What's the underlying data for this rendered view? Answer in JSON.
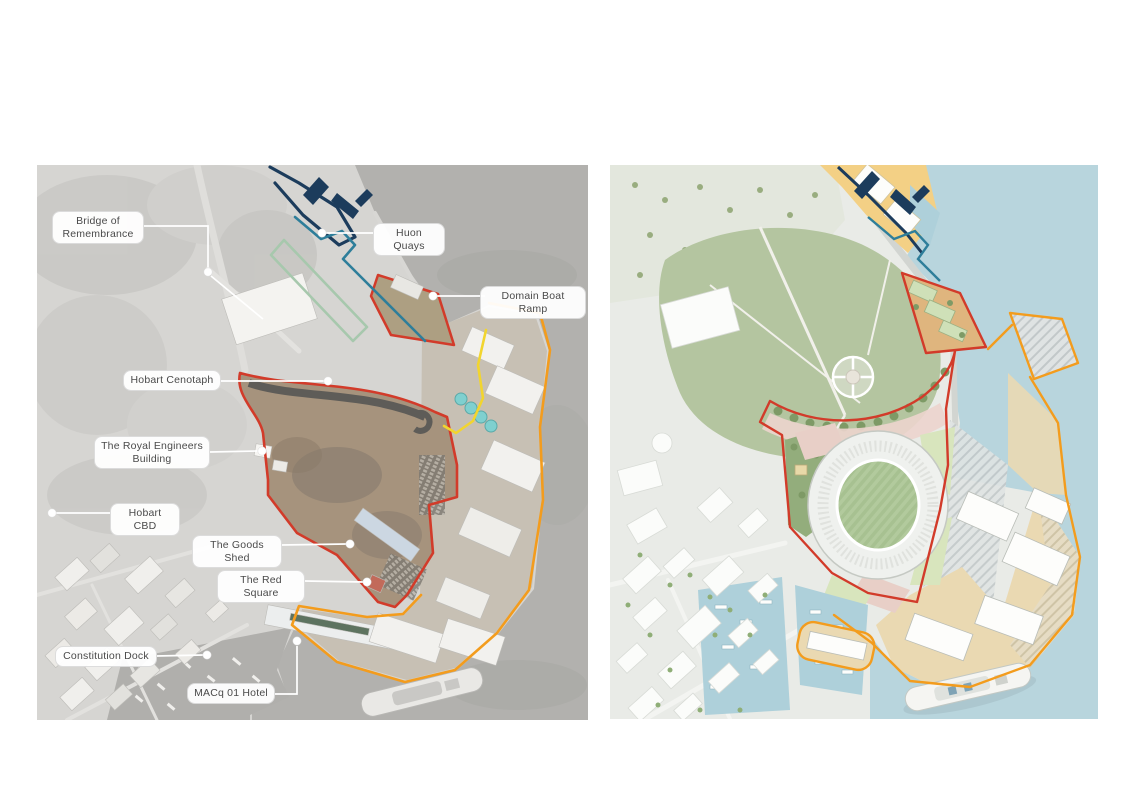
{
  "page": {
    "background": "#ffffff",
    "description": "Two-panel planning figure: desaturated aerial photograph of Macquarie Point Hobart with labelled landmarks (left) and coloured illustrative masterplan with stadium (right)"
  },
  "panels": {
    "left": {
      "name": "existing-site-aerial-photo",
      "labels": [
        {
          "id": "bridge-of-remembrance",
          "text": "Bridge of Remembrance"
        },
        {
          "id": "huon-quays",
          "text": "Huon Quays"
        },
        {
          "id": "domain-boat-ramp",
          "text": "Domain Boat Ramp"
        },
        {
          "id": "hobart-cenotaph",
          "text": "Hobart Cenotaph"
        },
        {
          "id": "royal-engineers-building",
          "text": "The Royal Engineers Building"
        },
        {
          "id": "hobart-cbd",
          "text": "Hobart CBD"
        },
        {
          "id": "the-goods-shed",
          "text": "The Goods Shed"
        },
        {
          "id": "the-red-square",
          "text": "The Red Square"
        },
        {
          "id": "constitution-dock",
          "text": "Constitution Dock"
        },
        {
          "id": "macq-01-hotel",
          "text": "MACq 01 Hotel"
        }
      ]
    },
    "right": {
      "name": "illustrative-masterplan",
      "labels": []
    }
  },
  "colors": {
    "boundary_red": "#d23b2a",
    "boundary_orange": "#f39c1d",
    "boundary_yellow": "#f2d52e",
    "boundary_navy": "#1c3c5c",
    "boundary_teal": "#2e7e9a",
    "boundary_sage": "#a7c8ad",
    "water_left": "#b2b1ae",
    "water_right": "#b8d5dd",
    "park_green": "#b4c5a0",
    "stadium_field_green": "#a7c191",
    "wharf_tan": "#ead9b2",
    "zone_yellow": "#f3d085",
    "site_dirt": "#a6937d",
    "label_text": "#4a4a4a",
    "label_background": "#ffffff"
  }
}
